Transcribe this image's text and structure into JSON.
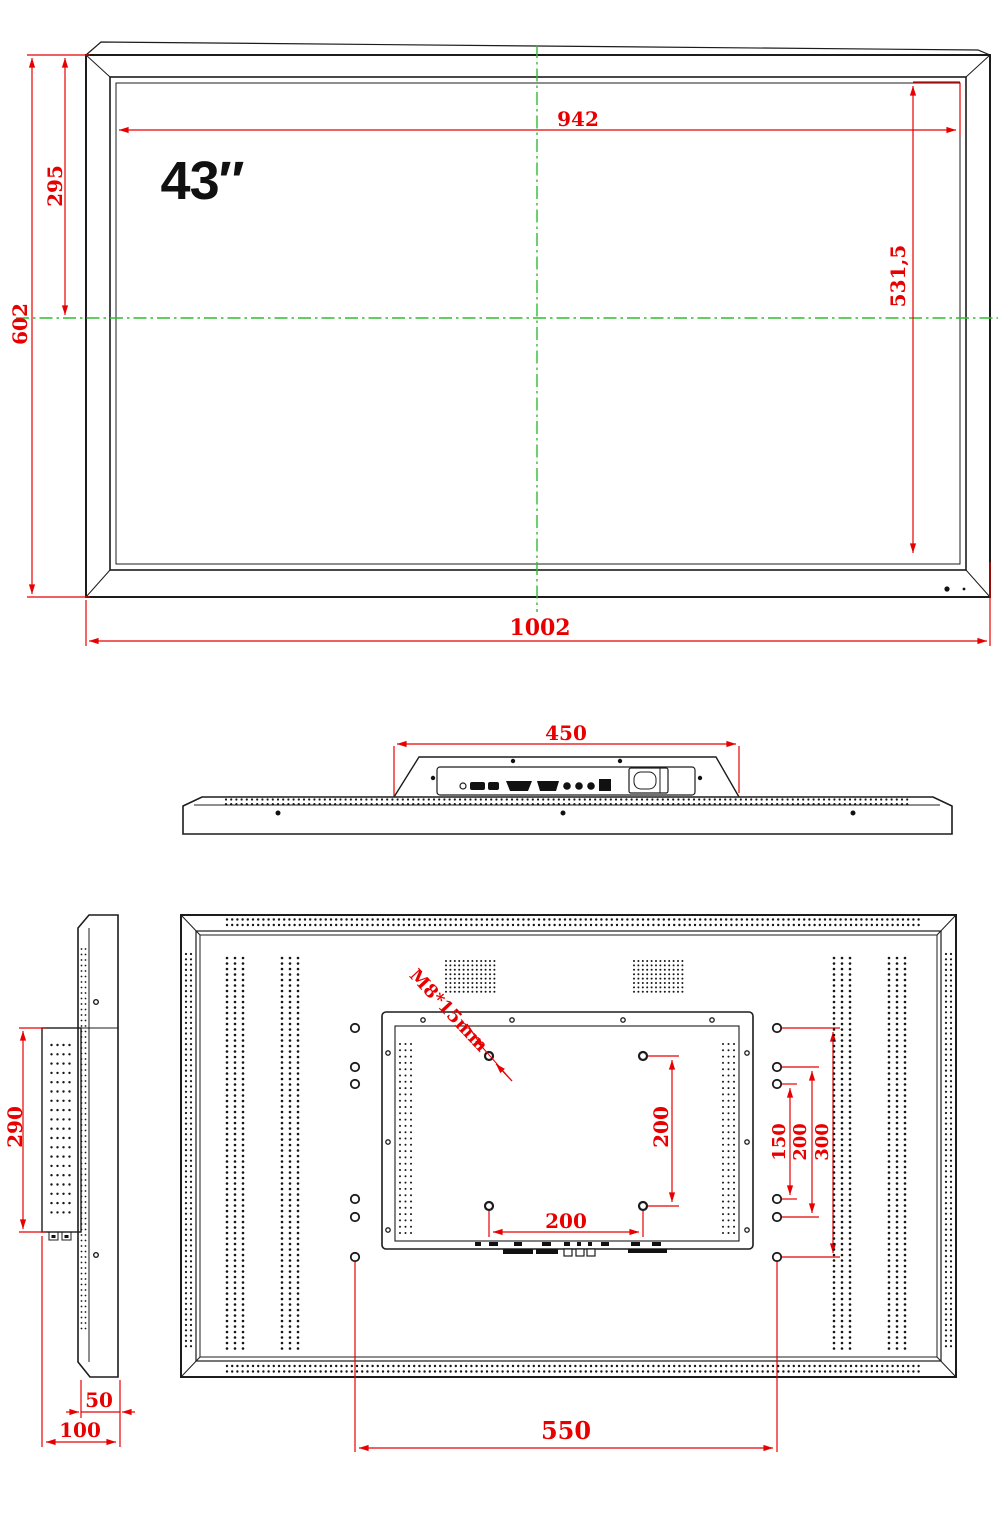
{
  "colors": {
    "dimension_red": "#e80000",
    "centerline_green": "#2ebd2e",
    "line_black": "#1c1c1c"
  },
  "front_view": {
    "size_label": "43″",
    "display_width": "942",
    "display_height": "531,5",
    "top_to_center": "295",
    "overall_height": "602",
    "overall_width": "1002"
  },
  "top_view": {
    "mount_width": "450"
  },
  "side_view": {
    "bracket_height": "290",
    "panel_depth": "50",
    "total_depth": "100"
  },
  "back_view": {
    "screw_spec": "M8*15mm",
    "vesa_height": "200",
    "vesa_width": "200",
    "span_150": "150",
    "span_200": "200",
    "span_300": "300",
    "bottom_span": "550"
  }
}
